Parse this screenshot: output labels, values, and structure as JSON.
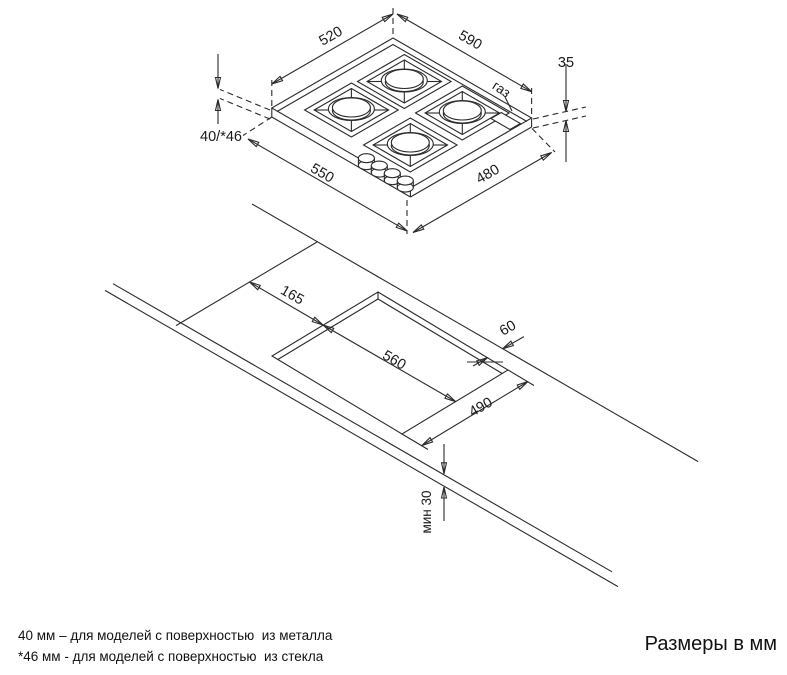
{
  "hob": {
    "dim_top_left": "520",
    "dim_top_right": "590",
    "dim_height": "35",
    "dim_total_height": "40/*46",
    "dim_bottom_left": "550",
    "dim_bottom_right": "480",
    "gas_label": "газ"
  },
  "worktop": {
    "dim_edge_offset": "165",
    "dim_cutout_length": "560",
    "dim_back_clearance": "60",
    "dim_cutout_width": "490",
    "dim_front_clearance": "мин 30"
  },
  "notes": {
    "metal": "40 мм – для моделей с поверхностью  из металла",
    "glass": "*46 мм - для моделей с поверхностью  из стекла"
  },
  "units_label": "Размеры в мм",
  "colors": {
    "line": "#2b2b2b",
    "background": "#ffffff",
    "text": "#1a1a1a"
  }
}
